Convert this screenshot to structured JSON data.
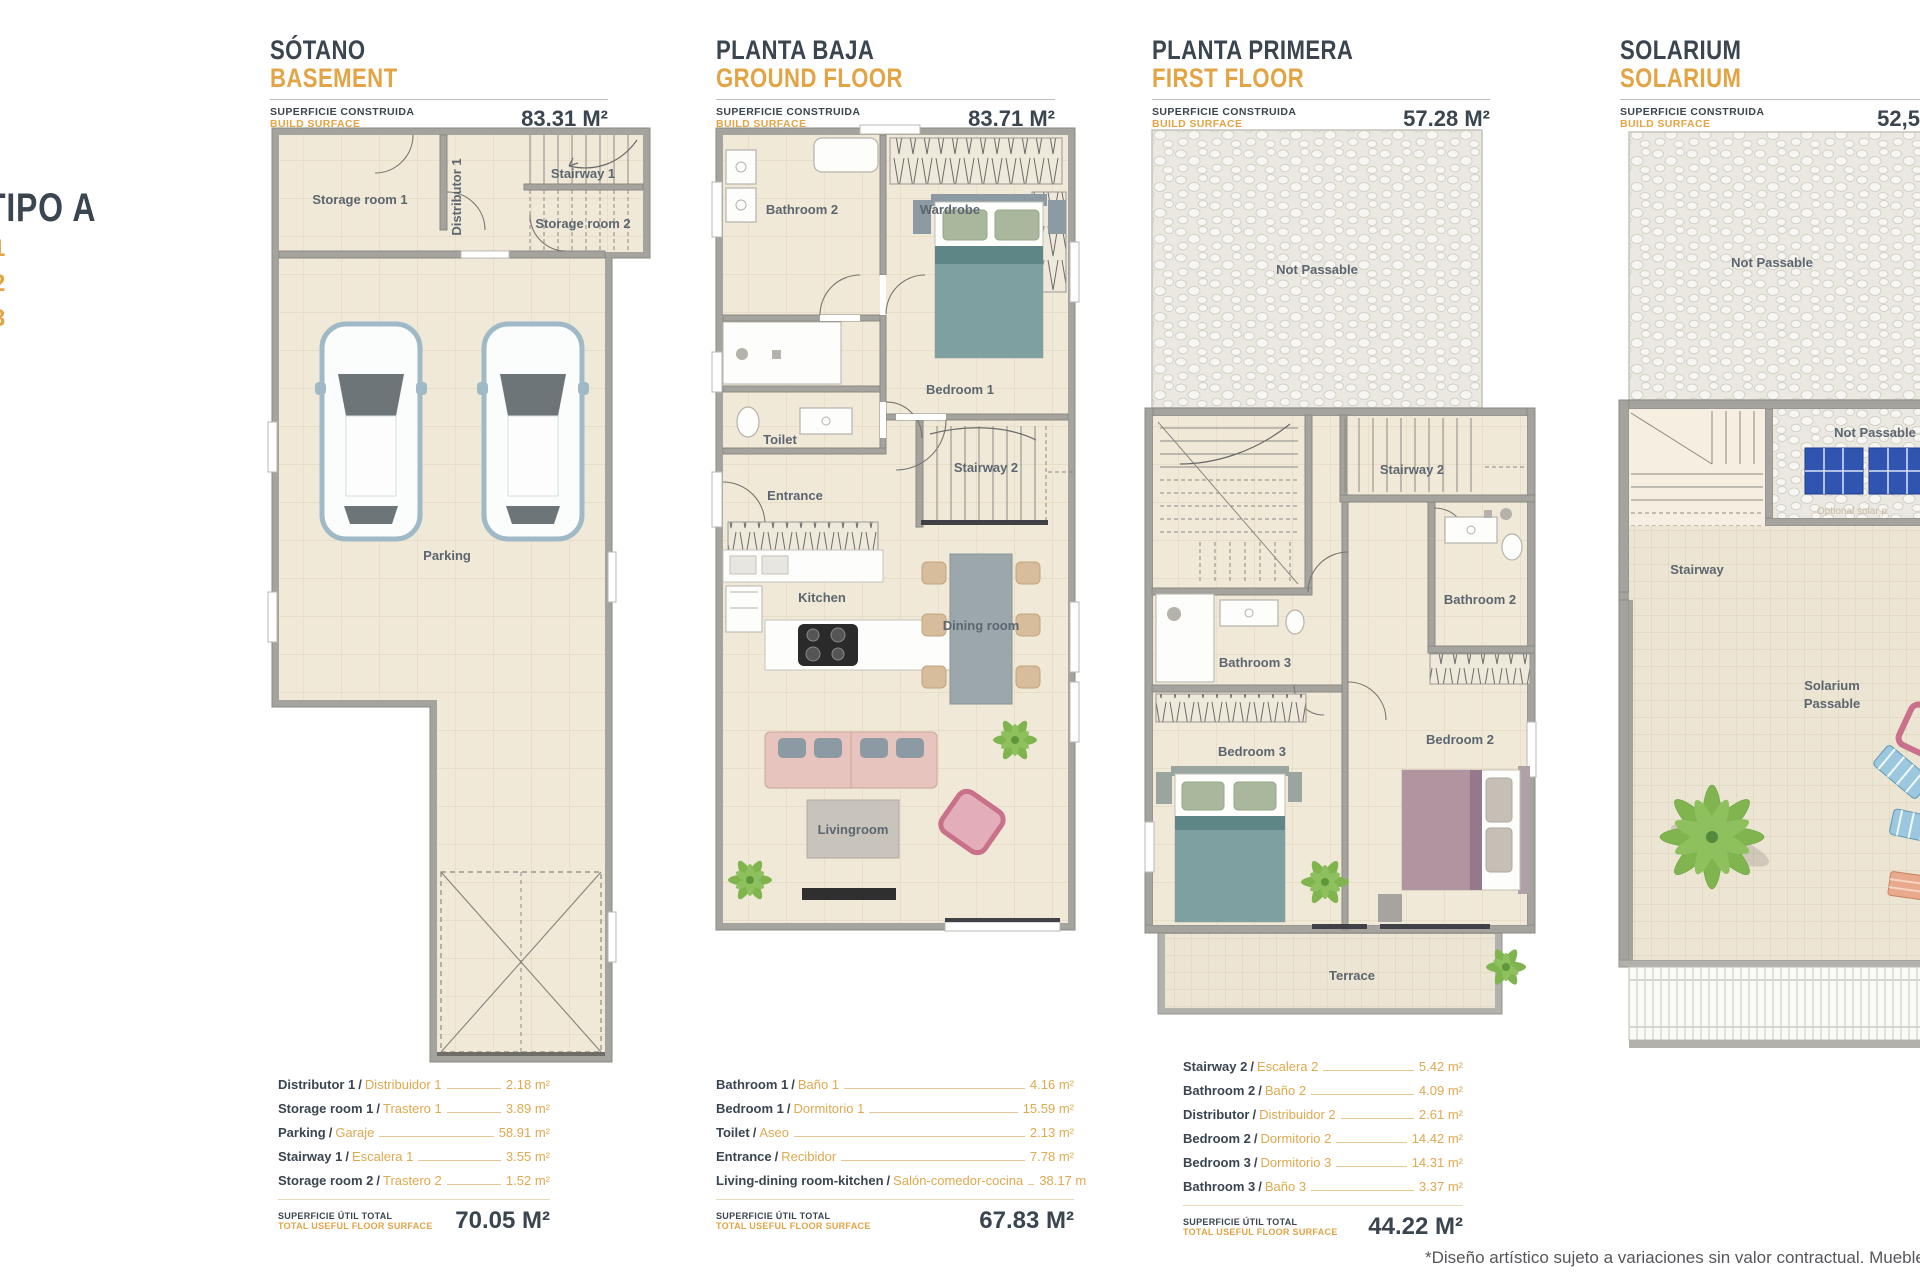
{
  "branding": {
    "tipo": "TIPO A",
    "variants": [
      "1",
      "2",
      "3"
    ]
  },
  "labels": {
    "surface_es": "SUPERFICIE CONSTRUIDA",
    "surface_en": "BUILD SURFACE",
    "total_es": "SUPERFICIE ÚTIL TOTAL",
    "total_en": "TOTAL USEFUL FLOOR SURFACE",
    "slash": "/"
  },
  "plans": {
    "basement": {
      "title_es": "SÓTANO",
      "title_en": "BASEMENT",
      "build_surface": "83.31 M²",
      "rooms": {
        "storage1": "Storage room 1",
        "distributor": "Distributor 1",
        "stairway1": "Stairway 1",
        "storage2": "Storage room 2",
        "parking": "Parking"
      }
    },
    "ground": {
      "title_es": "PLANTA BAJA",
      "title_en": "GROUND FLOOR",
      "build_surface": "83.71 M²",
      "rooms": {
        "bathroom2": "Bathroom 2",
        "wardrobe": "Wardrobe",
        "toilet": "Toilet",
        "bedroom1": "Bedroom 1",
        "entrance": "Entrance",
        "stairway2": "Stairway 2",
        "kitchen": "Kitchen",
        "dining": "Dining room",
        "living": "Livingroom"
      }
    },
    "first": {
      "title_es": "PLANTA PRIMERA",
      "title_en": "FIRST FLOOR",
      "build_surface": "57.28 M²",
      "rooms": {
        "not_passable": "Not Passable",
        "stairway2": "Stairway 2",
        "bathroom2": "Bathroom 2",
        "bathroom3": "Bathroom 3",
        "bedroom3": "Bedroom 3",
        "bedroom2": "Bedroom 2",
        "terrace": "Terrace"
      }
    },
    "solarium": {
      "title_es": "SOLARIUM",
      "title_en": "SOLARIUM",
      "build_surface": "52,5",
      "rooms": {
        "not_passable_top": "Not Passable",
        "not_passable_mid": "Not Passable",
        "solar_note": "Optional solar p",
        "stairway": "Stairway",
        "solarium_line1": "Solarium",
        "solarium_line2": "Passable"
      }
    }
  },
  "tables": {
    "basement": {
      "rows": [
        {
          "en": "Distributor 1",
          "es": "Distribuidor 1",
          "value": "2.18 m²"
        },
        {
          "en": "Storage room 1",
          "es": "Trastero 1",
          "value": "3.89 m²"
        },
        {
          "en": "Parking",
          "es": "Garaje",
          "value": "58.91 m²"
        },
        {
          "en": "Stairway 1",
          "es": "Escalera 1",
          "value": "3.55 m²"
        },
        {
          "en": "Storage room 2",
          "es": "Trastero 2",
          "value": "1.52 m²"
        }
      ],
      "total": "70.05 M²"
    },
    "ground": {
      "rows": [
        {
          "en": "Bathroom 1",
          "es": "Baño 1",
          "value": "4.16 m²"
        },
        {
          "en": "Bedroom 1",
          "es": "Dormitorio 1",
          "value": "15.59 m²"
        },
        {
          "en": "Toilet",
          "es": "Aseo",
          "value": "2.13 m²"
        },
        {
          "en": "Entrance",
          "es": "Recibidor",
          "value": "7.78 m²"
        },
        {
          "en": "Living-dining room-kitchen",
          "es": "Salón-comedor-cocina",
          "value": "38.17 m"
        }
      ],
      "total": "67.83 M²"
    },
    "first": {
      "rows": [
        {
          "en": "Stairway 2",
          "es": "Escalera 2",
          "value": "5.42 m²"
        },
        {
          "en": "Bathroom 2",
          "es": "Baño 2",
          "value": "4.09 m²"
        },
        {
          "en": "Distributor",
          "es": "Distribuidor 2",
          "value": "2.61 m²"
        },
        {
          "en": "Bedroom 2",
          "es": "Dormitorio 2",
          "value": "14.42 m²"
        },
        {
          "en": "Bedroom 3",
          "es": "Dormitorio 3",
          "value": "14.31 m²"
        },
        {
          "en": "Bathroom 3",
          "es": "Baño 3",
          "value": "3.37 m²"
        }
      ],
      "total": "44.22 M²"
    }
  },
  "footnote": "*Diseño artístico sujeto a variaciones sin valor contractual. Muebles no",
  "colors": {
    "ink": "#3A4550",
    "accent_orange": "#E2A444",
    "wall_gray": "#A5A39E",
    "floor_beige": "#F1E9D8",
    "bed_teal": "#7FA0A0",
    "bed_mauve": "#B294A0",
    "sofa_pink": "#E8C4BE",
    "plant_green": "#7FB44E",
    "solar_blue": "#2F55B0"
  }
}
